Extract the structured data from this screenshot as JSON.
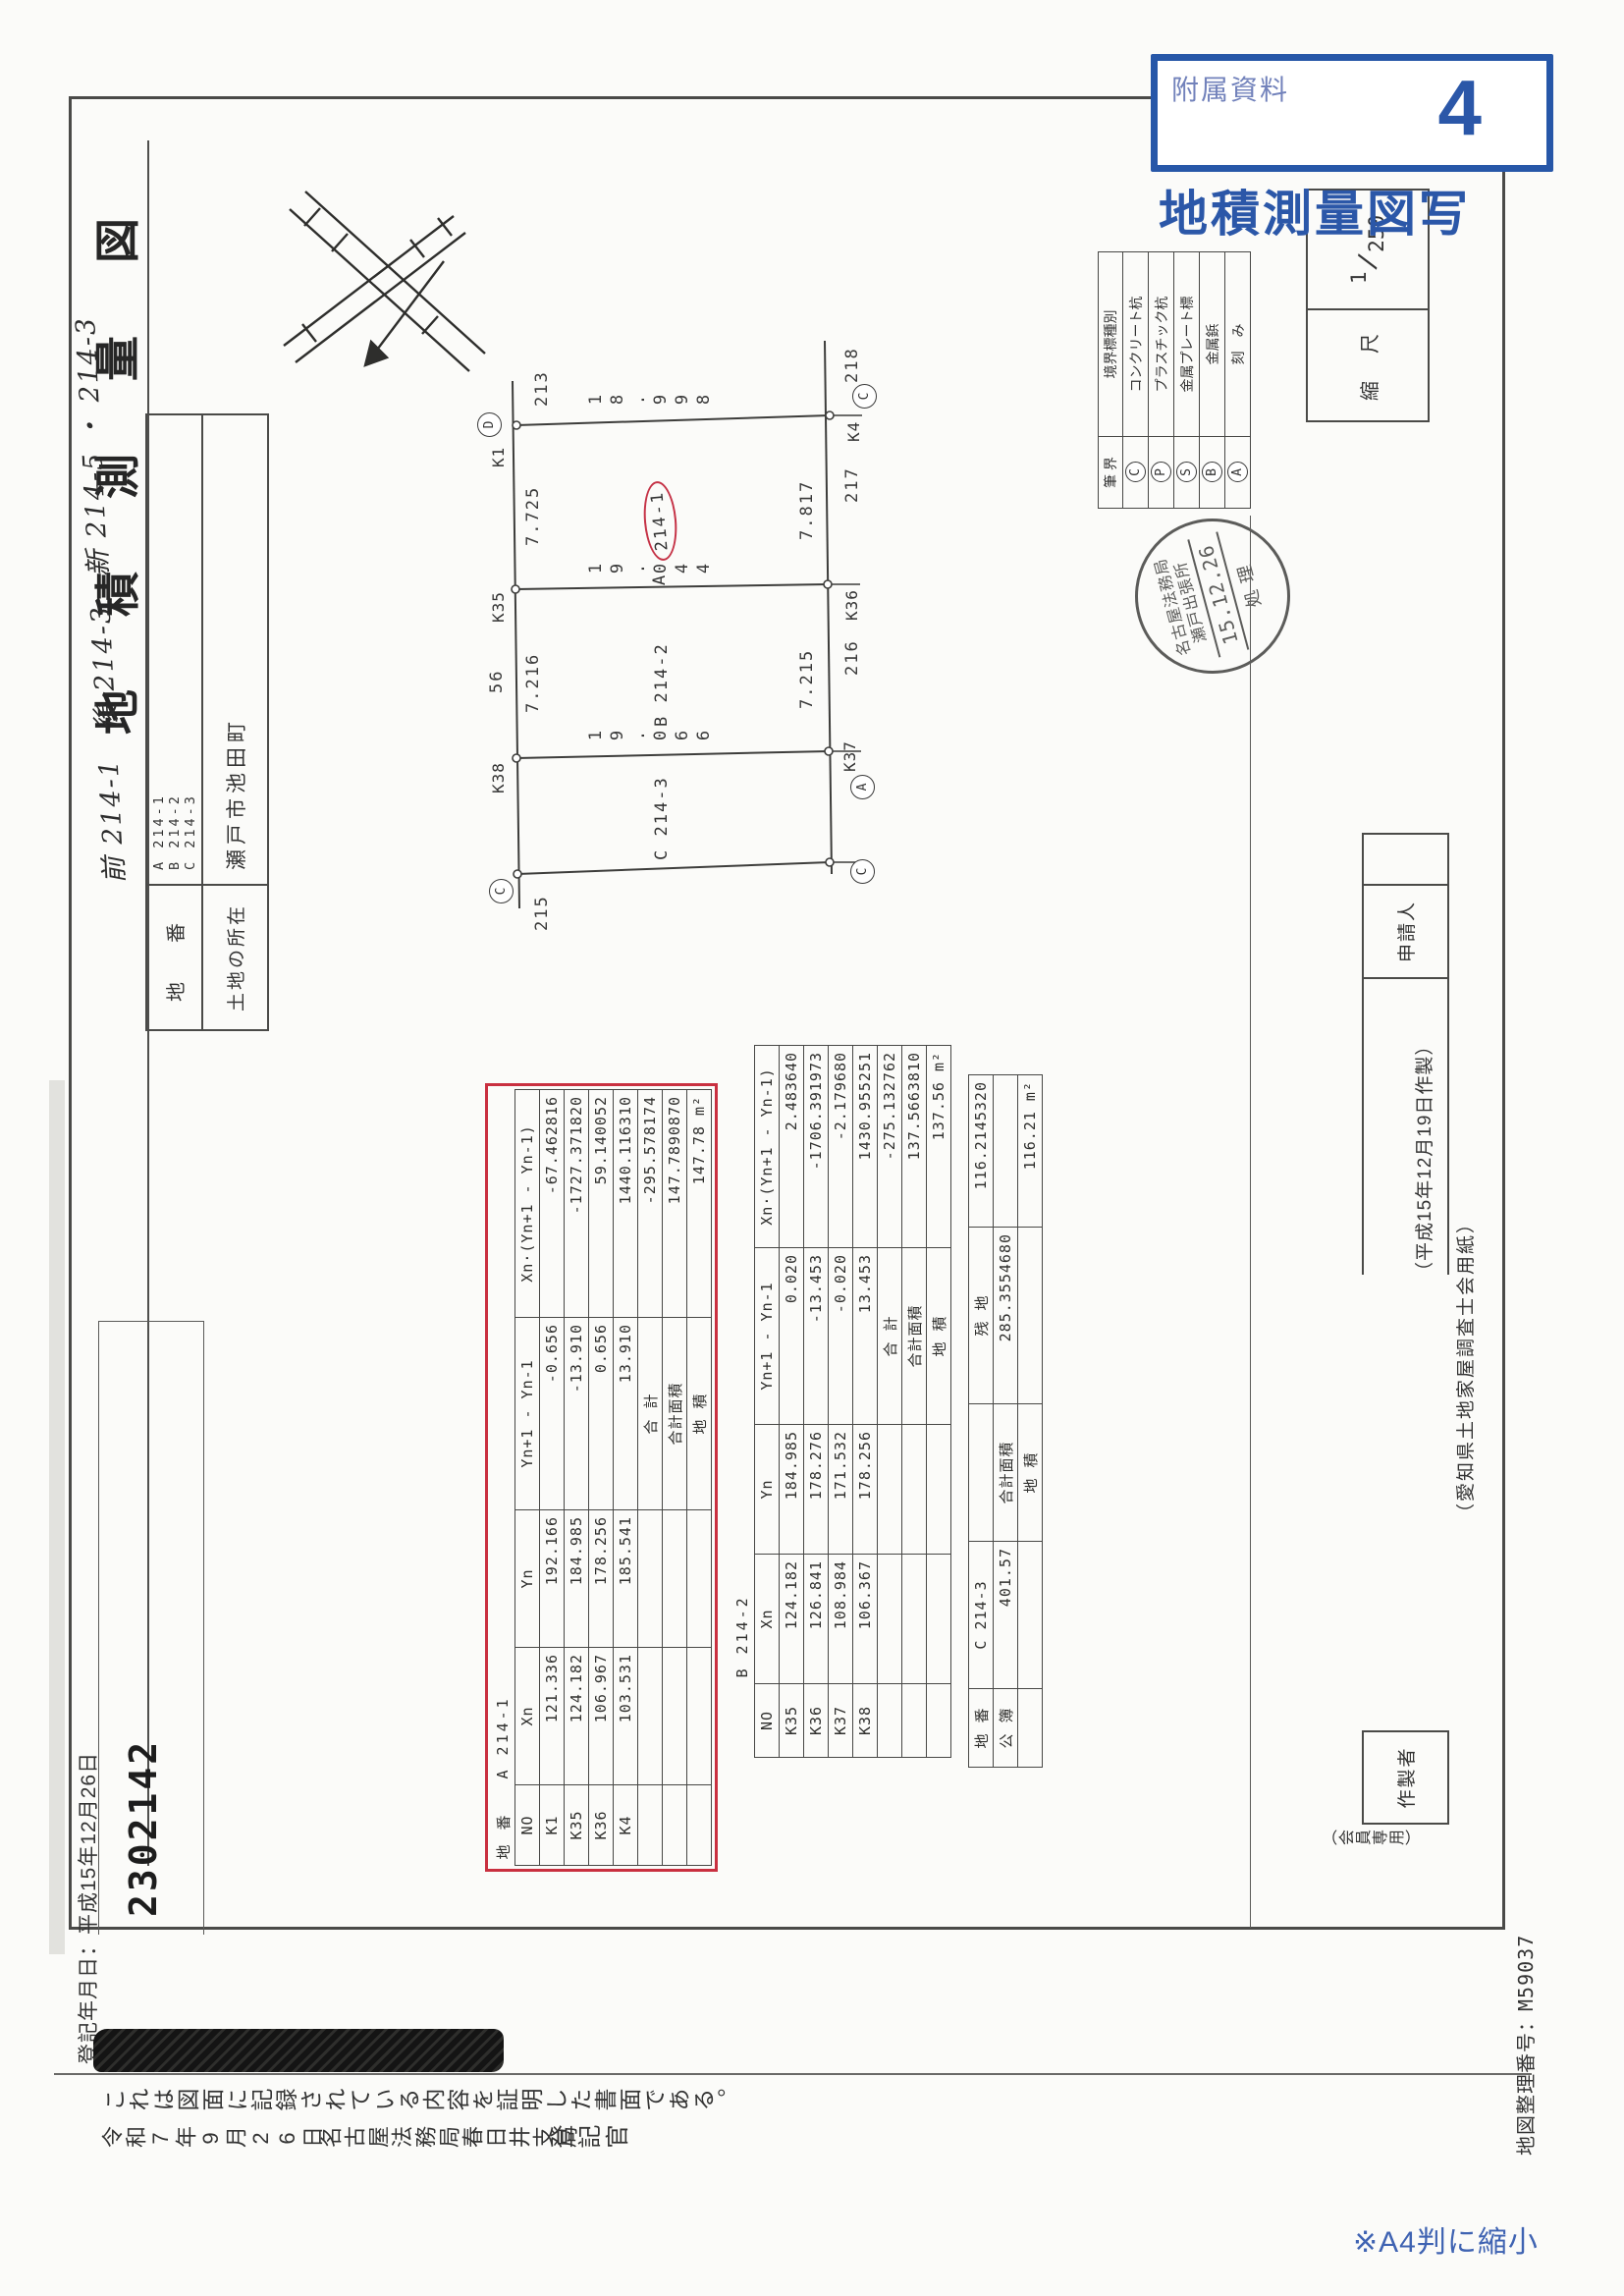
{
  "annotations": {
    "attachment_label": "附属資料",
    "attachment_number": "4",
    "copy_title": "地積測量図写",
    "reduction_note": "※A4判に縮小",
    "accent_color": "#2b57a8"
  },
  "certificate": {
    "registration_date": "登記年月日：平成15年12月26日",
    "receipt_number": "2302142",
    "statement": "これは図面に記録されている内容を証明した書面である。",
    "issue_date": "令和7年9月26日",
    "bureau": "名古屋法務局春日井支局",
    "officer_title": "登記官",
    "map_number": "地図整理番号：M59037"
  },
  "form": {
    "title": "地　積　測　量　図",
    "handwritten_note": "前 214-1　後 214-3　新 214-5 ・ 214-3",
    "parcel_label": "地　番",
    "parcel_numbers": [
      "A 214-1",
      "B 214-2",
      "C 214-3"
    ],
    "location_label": "土地の所在",
    "location": "瀬戸市池田町",
    "scale_label": "縮　尺",
    "scale_num": "1",
    "scale_den": "250",
    "applicant_label": "申請人",
    "preparer_label": "作製者",
    "member_note": "（会員専用）",
    "made_note": "（平成15年12月19日作製）",
    "paper_note": "（愛知県土地家屋調査士会用紙）"
  },
  "stamp": {
    "line1": "名古屋法務局",
    "line2": "瀬戸出張所",
    "date": "15.12.26",
    "word": "処理"
  },
  "legend": {
    "header_left": "筆 界",
    "header_right": "境界標種別",
    "rows": [
      {
        "mark": "C",
        "name": "コンクリート杭"
      },
      {
        "mark": "P",
        "name": "プラスチック杭"
      },
      {
        "mark": "S",
        "name": "金属プレート標"
      },
      {
        "mark": "B",
        "name": "金属鋲"
      },
      {
        "mark": "A",
        "name": "刻　み"
      }
    ]
  },
  "drawing": {
    "parcels": [
      {
        "prefix": "A",
        "number": "214-1"
      },
      {
        "prefix": "B",
        "number": "214-2"
      },
      {
        "prefix": "C",
        "number": "214-3"
      }
    ],
    "dims": {
      "d_k1k4": "18.998",
      "d_k35k36": "19.044",
      "d_k38k37": "19.066",
      "w_a_top": "7.725",
      "w_a_bot": "7.817",
      "w_b_top": "7.216",
      "w_b_bot": "7.215"
    },
    "neighbors": {
      "n213": "213",
      "n215": "215",
      "n216": "216",
      "n217": "217",
      "n218": "218",
      "n56": "56"
    },
    "points": {
      "k1": "K1",
      "k35": "K35",
      "k38": "K38",
      "k4": "K4",
      "k36": "K36",
      "k37": "K37",
      "mark_c": "C",
      "mark_a": "A",
      "mark_d": "D"
    }
  },
  "tables": {
    "a": {
      "title_label": "地 番",
      "title": "A 214-1",
      "headers": [
        "NO",
        "Xn",
        "Yn",
        "Yn+1 - Yn-1",
        "Xn·(Yn+1 - Yn-1)"
      ],
      "rows": [
        [
          "K1",
          "121.336",
          "192.166",
          "-0.656",
          "-67.462816"
        ],
        [
          "K35",
          "124.182",
          "184.985",
          "-13.910",
          "-1727.371820"
        ],
        [
          "K36",
          "106.967",
          "178.256",
          "0.656",
          "59.140052"
        ],
        [
          "K4",
          "103.531",
          "185.541",
          "13.910",
          "1440.116310"
        ],
        [
          "",
          "",
          "",
          "合 計",
          "-295.578174"
        ],
        [
          "",
          "",
          "",
          "合計面積",
          "147.7890870"
        ],
        [
          "",
          "",
          "",
          "地 積",
          "147.78 m²"
        ]
      ]
    },
    "b": {
      "title_label": "",
      "title": "B 214-2",
      "headers": [
        "NO",
        "Xn",
        "Yn",
        "Yn+1 - Yn-1",
        "Xn·(Yn+1 - Yn-1)"
      ],
      "rows": [
        [
          "K35",
          "124.182",
          "184.985",
          "0.020",
          "2.483640"
        ],
        [
          "K36",
          "126.841",
          "178.276",
          "-13.453",
          "-1706.391973"
        ],
        [
          "K37",
          "108.984",
          "171.532",
          "-0.020",
          "-2.179680"
        ],
        [
          "K38",
          "106.367",
          "178.256",
          "13.453",
          "1430.955251"
        ],
        [
          "",
          "",
          "",
          "合 計",
          "-275.132762"
        ],
        [
          "",
          "",
          "",
          "合計面積",
          "137.5663810"
        ],
        [
          "",
          "",
          "",
          "地 積",
          "137.56 m²"
        ]
      ]
    },
    "c": {
      "rows": [
        [
          "地 番",
          "C 214-3",
          "",
          "残 地",
          "116.2145320"
        ],
        [
          "公 簿",
          "401.57",
          "合計面積",
          "285.3554680",
          ""
        ],
        [
          "",
          "",
          "地 積",
          "",
          "116.21 m²"
        ]
      ]
    }
  }
}
